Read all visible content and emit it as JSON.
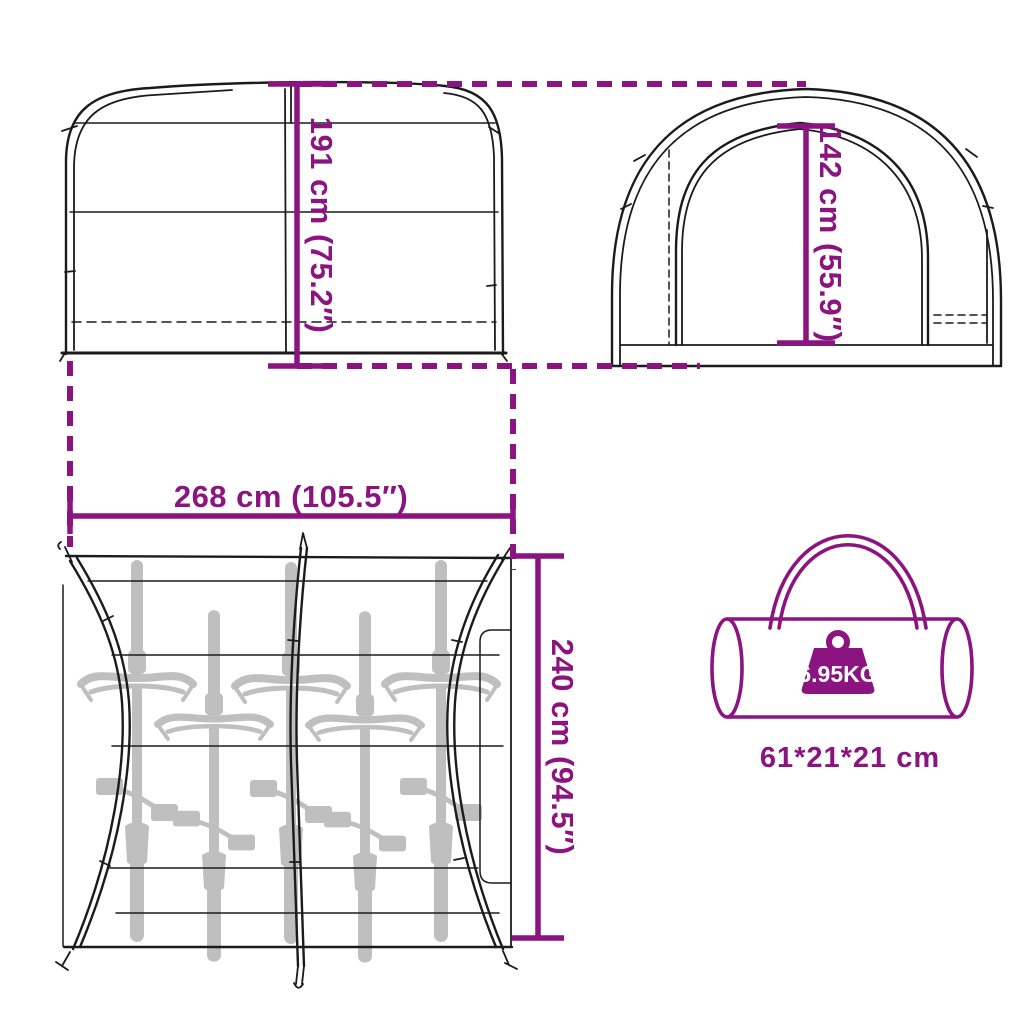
{
  "diagram": {
    "title": "bike-storage-tent-dimension-diagram",
    "dimensions": {
      "side_height": "191 cm (75.2″)",
      "front_height": "142 cm (55.9″)",
      "width": "268 cm (105.5″)",
      "depth": "240 cm (94.5″)"
    },
    "bag": {
      "weight": "6.95KG",
      "packed_size": "61*21*21 cm"
    },
    "bike_count": 5,
    "colors": {
      "accent": "#8B1480",
      "line": "#1b1b1b",
      "bike_silhouette": "#bfbfbf",
      "background": "#ffffff",
      "weight_label_text": "#ffffff"
    }
  }
}
